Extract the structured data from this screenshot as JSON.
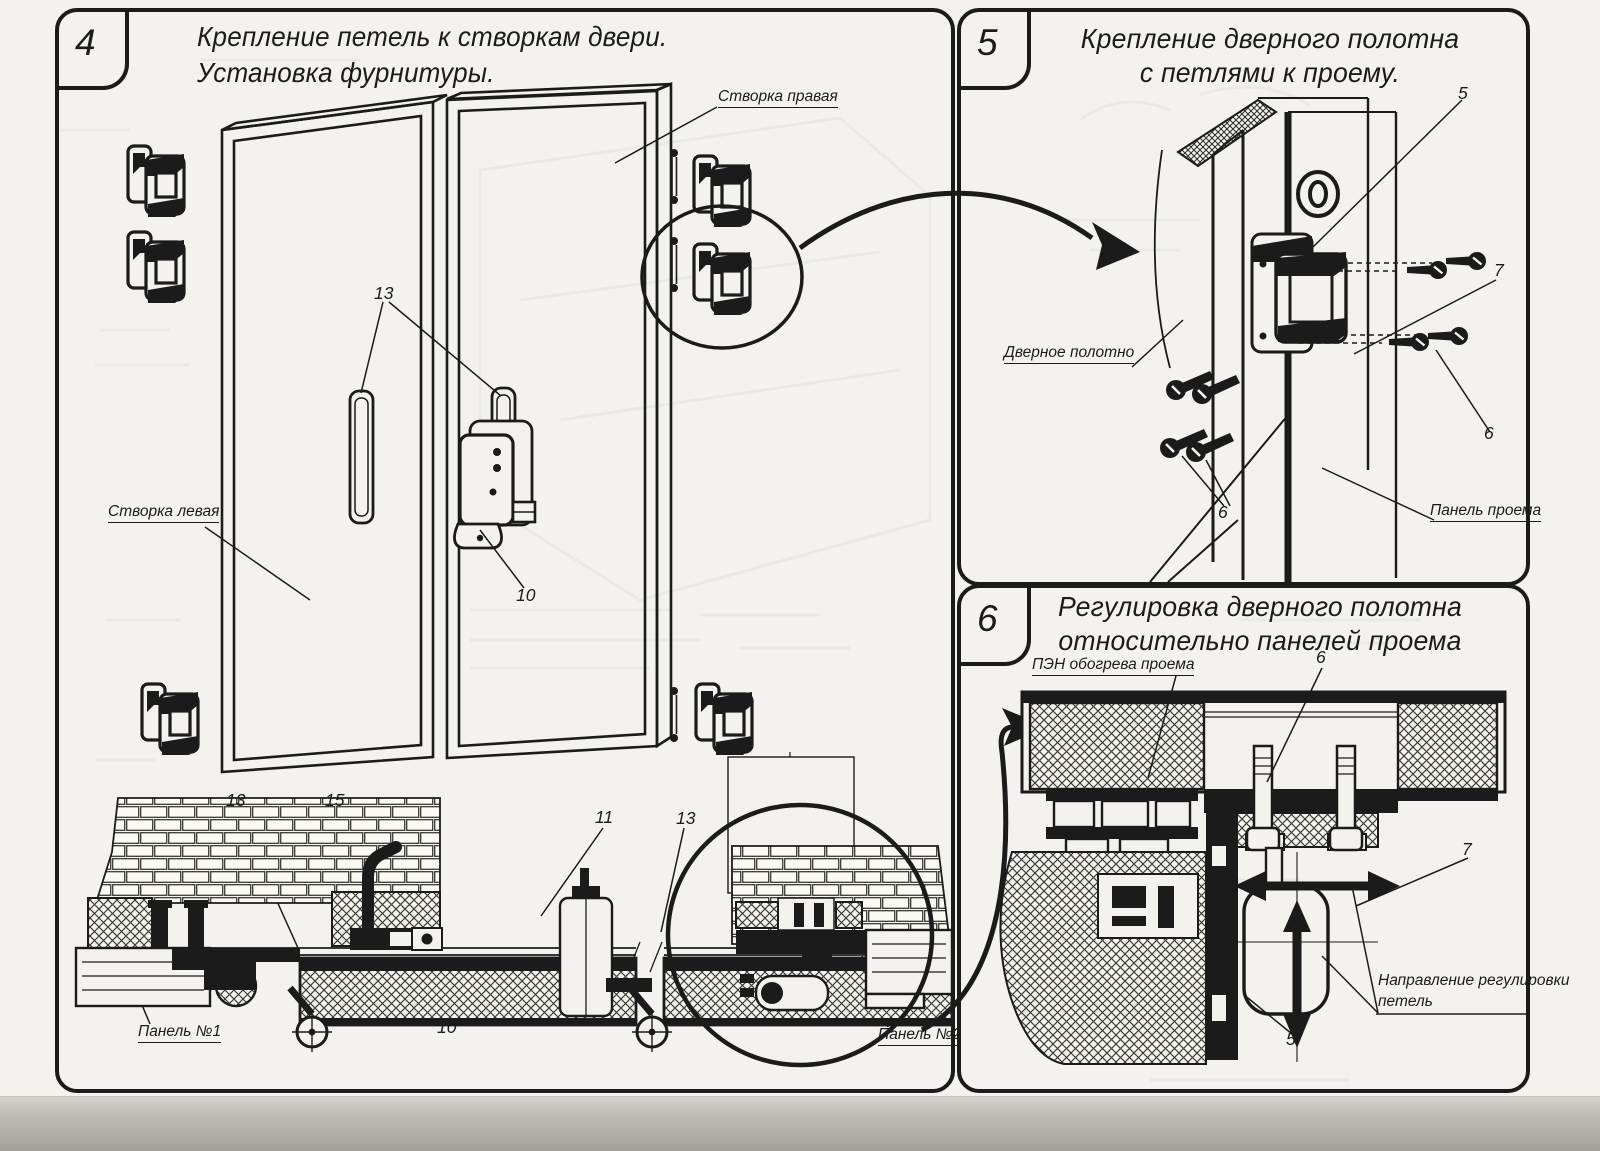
{
  "sheet": {
    "paper_color": "#f3f2ee",
    "ink_color": "#1b1b1b"
  },
  "panel4": {
    "number": "4",
    "title_line1": "Крепление петель к створкам двери.",
    "title_line2": "Установка фурнитуры.",
    "labels": {
      "right_leaf": "Створка правая",
      "left_leaf": "Створка левая",
      "panel_1": "Панель №1",
      "panel_2": "Панель №2"
    },
    "callouts": {
      "handles": "13",
      "lock": "10",
      "section_hinge": "13",
      "stay": "15",
      "roller": "11",
      "section_hinge2": "13",
      "section_lock": "10"
    }
  },
  "panel5": {
    "number": "5",
    "title_line1": "Крепление дверного полотна",
    "title_line2": "с петлями к проему.",
    "labels": {
      "door_leaf": "Дверное полотно",
      "opening_panel": "Панель проема"
    },
    "callouts": {
      "hinge": "5",
      "bracket": "7",
      "screw_right": "6",
      "screws_left": "6"
    }
  },
  "panel6": {
    "number": "6",
    "title_line1": "Регулировка дверного полотна",
    "title_line2": "относительно панелей проема",
    "labels": {
      "heater": "ПЭН обогрева проема",
      "direction_line1": "Направление регулировки",
      "direction_line2": "петель"
    },
    "callouts": {
      "bolt": "6",
      "bracket": "7",
      "hinge": "5"
    }
  }
}
